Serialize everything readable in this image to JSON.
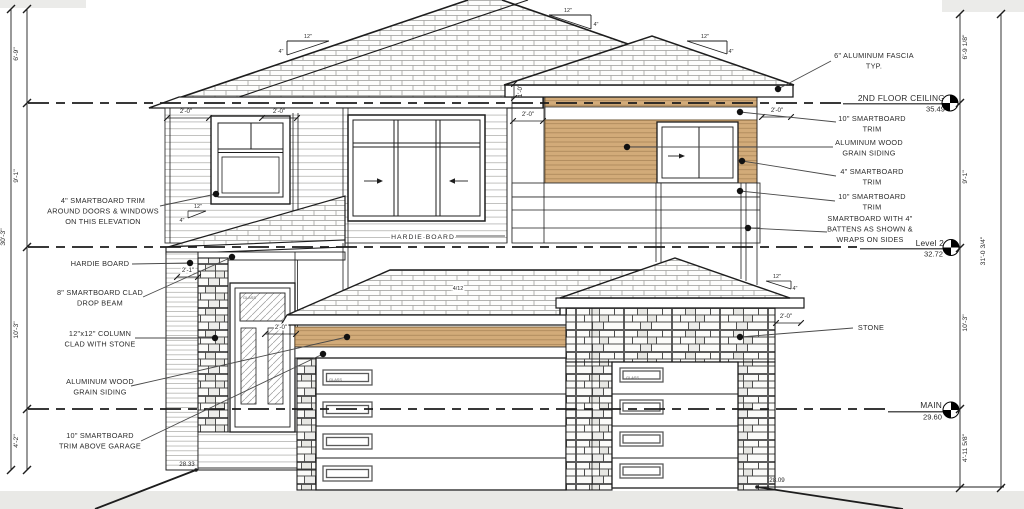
{
  "title": "House Front Elevation Drawing",
  "colors": {
    "tan": "#d2ab79",
    "paper": "#ffffff",
    "ground": "#e9e9e6",
    "line": "#1d1d1d"
  },
  "levels": [
    {
      "name": "2ND FLOOR CEILING",
      "elevation": "35.49"
    },
    {
      "name": "Level 2",
      "elevation": "32.72"
    },
    {
      "name": "MAIN",
      "elevation": "29.60"
    }
  ],
  "grade": {
    "left": "28.33",
    "right": "28.09"
  },
  "dims_left": {
    "seg1": "6'-9\"",
    "seg2": "9'-1\"",
    "overall": "30'-3\"",
    "seg3": "10'-3\"",
    "seg4": "4'-2\""
  },
  "dims_right": {
    "seg1": "6'-9 1/8\"",
    "seg2": "9'-1\"",
    "overall": "31'-0 3/4\"",
    "seg3": "10'-3\"",
    "seg4": "4'-11 5/8\""
  },
  "callouts_left": {
    "trim_windows": {
      "l1": "4\" SMARTBOARD TRIM",
      "l2": "AROUND DOORS & WINDOWS",
      "l3": "ON THIS ELEVATION"
    },
    "hardie": "HARDIE BOARD",
    "drop_beam": {
      "l1": "8\" SMARTBOARD CLAD",
      "l2": "DROP BEAM"
    },
    "column": {
      "l1": "12\"x12\" COLUMN",
      "l2": "CLAD WITH STONE"
    },
    "alum": {
      "l1": "ALUMINUM WOOD",
      "l2": "GRAIN SIDING"
    },
    "trim_garage": {
      "l1": "10\" SMARTBOARD",
      "l2": "TRIM ABOVE GARAGE"
    }
  },
  "callouts_right": {
    "fascia": {
      "l1": "6\" ALUMINUM FASCIA",
      "l2": "TYP."
    },
    "trim10_a": {
      "l1": "10\" SMARTBOARD",
      "l2": "TRIM"
    },
    "alum": {
      "l1": "ALUMINUM WOOD",
      "l2": "GRAIN SIDING"
    },
    "trim4": {
      "l1": "4\" SMARTBOARD",
      "l2": "TRIM"
    },
    "trim10_b": {
      "l1": "10\" SMARTBOARD",
      "l2": "TRIM"
    },
    "battens": {
      "l1": "SMARTBOARD WITH 4\"",
      "l2": "BATTENS AS SHOWN &",
      "l3": "WRAPS ON SIDES"
    },
    "stone": "STONE"
  },
  "annotations": {
    "hardie_center": "HARDIE BOARD",
    "garage_slope": "4/12",
    "glass": "GLASS"
  },
  "slope": {
    "run": "12\"",
    "rise": "4\""
  },
  "small_dims": {
    "d20": "2'-0\"",
    "d21": "2'-1\"",
    "d10": "1'-0\""
  }
}
